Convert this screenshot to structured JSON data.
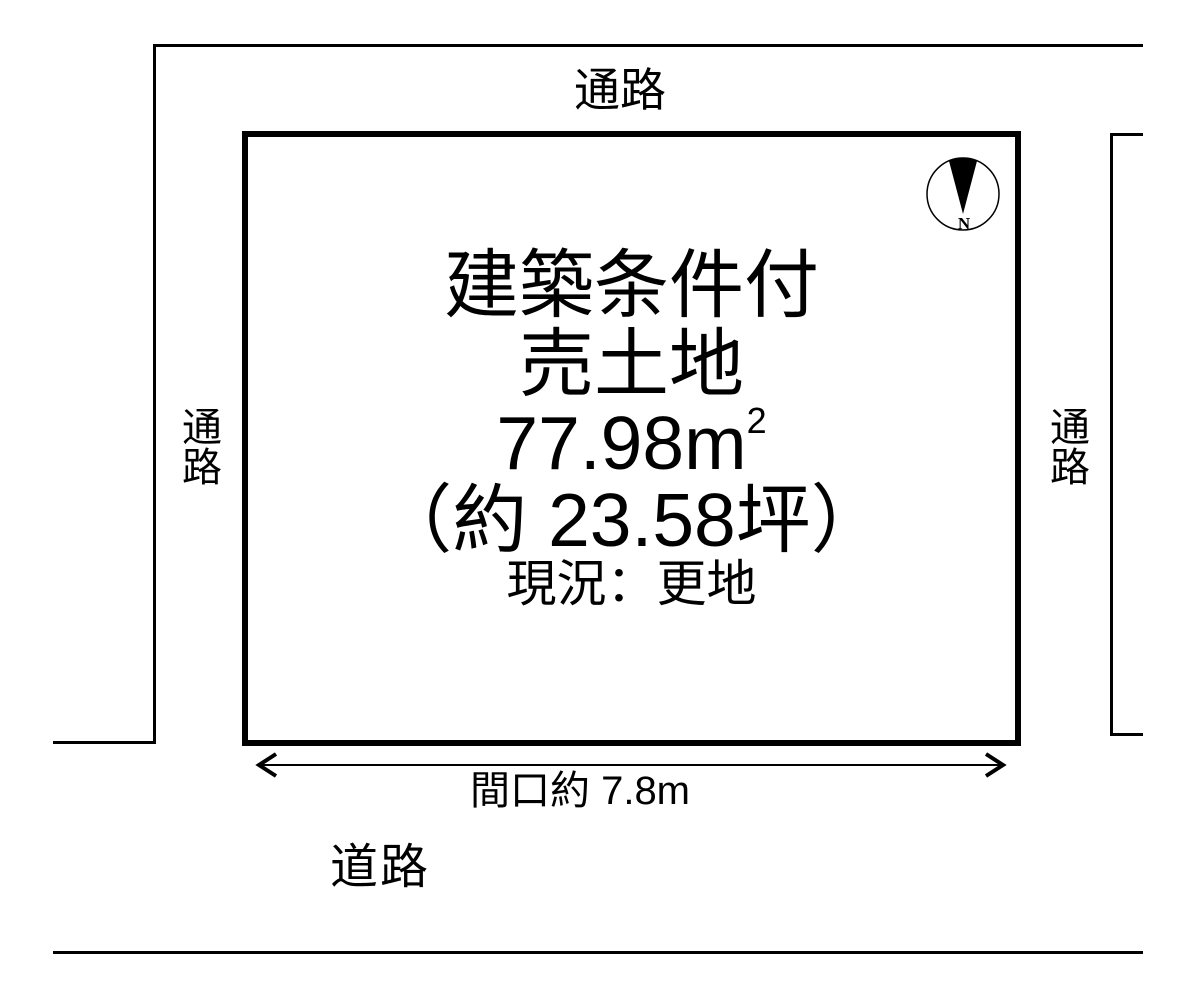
{
  "diagram": {
    "labels": {
      "passage_top": "通路",
      "passage_left": "通路",
      "passage_right": "通路",
      "road": "道路",
      "frontage": "間口約 7.8m"
    },
    "plot": {
      "title_line1": "建築条件付",
      "title_line2": "売土地",
      "area_value": "77.98",
      "area_unit": "m",
      "area_exponent": "2",
      "area_tsubo": "（約 23.58坪）",
      "current_status": "現況：更地"
    },
    "compass": {
      "north": "N"
    },
    "colors": {
      "ink": "#000000",
      "background": "#ffffff"
    }
  }
}
